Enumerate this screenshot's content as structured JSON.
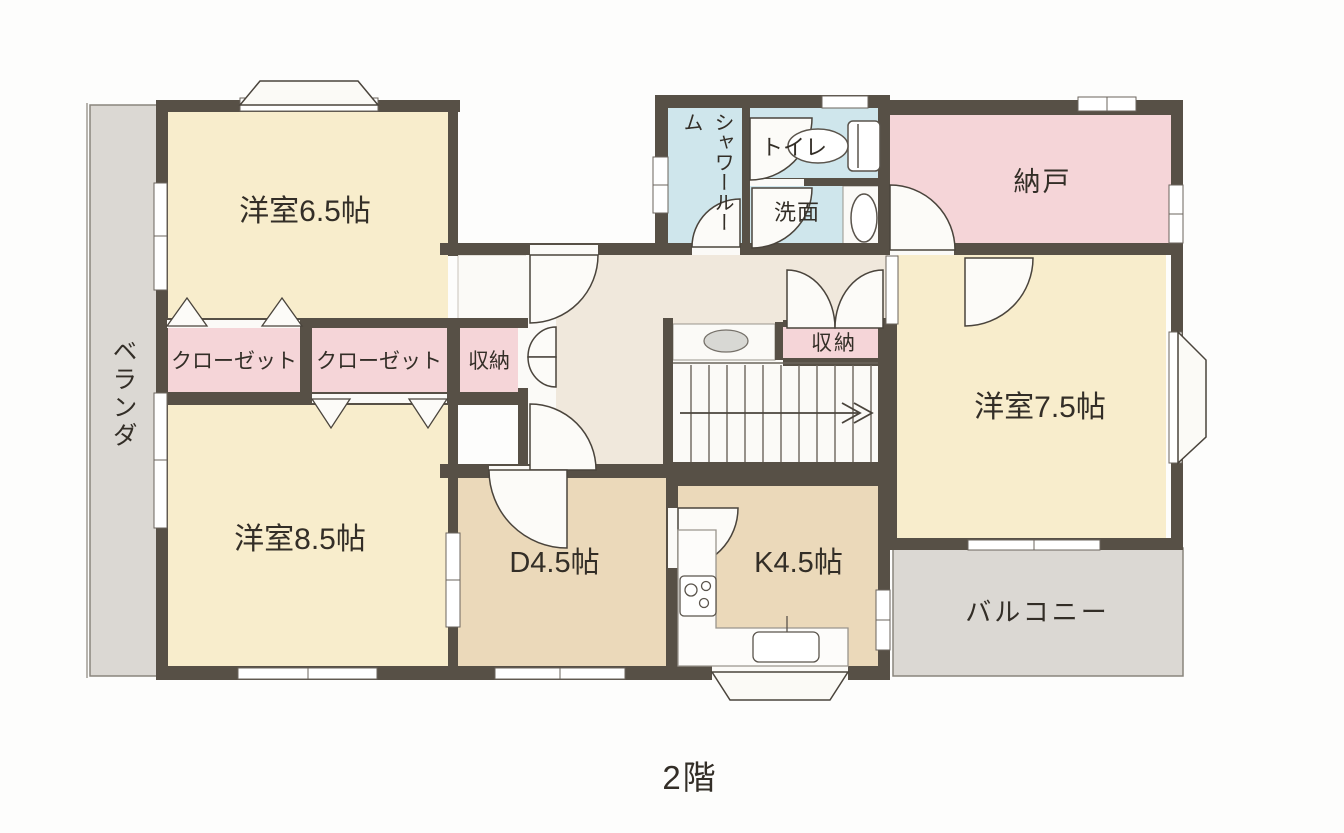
{
  "page": {
    "background": "#fdfdfc",
    "floor_label": "2階"
  },
  "colors": {
    "wall": "#575046",
    "room_cream": "#f8edcc",
    "dining_tan": "#ebd9ba",
    "storage_pink": "#f5d5d8",
    "bath_blue": "#cfe6ec",
    "hall_beige": "#f0e8dc",
    "outdoor_gray": "#dbd8d3",
    "floor_white": "#fbfaf7",
    "fixture_gray": "#d8d8d4"
  },
  "rooms": {
    "western_6_5": {
      "label": "洋室6.5帖"
    },
    "western_8_5": {
      "label": "洋室8.5帖"
    },
    "western_7_5": {
      "label": "洋室7.5帖"
    },
    "dining": {
      "label": "D4.5帖"
    },
    "kitchen": {
      "label": "K4.5帖"
    },
    "storage_room": {
      "label": "納戸"
    },
    "shower_room": {
      "label": "シャワールーム"
    },
    "toilet": {
      "label": "トイレ"
    },
    "washroom": {
      "label": "洗面"
    },
    "closet_left": {
      "label": "クローゼット"
    },
    "closet_right": {
      "label": "クローゼット"
    },
    "storage_small_hall": {
      "label": "収納"
    },
    "storage_small_stairs": {
      "label": "収納"
    },
    "veranda": {
      "label": "ベランダ"
    },
    "balcony": {
      "label": "バルコニー"
    }
  }
}
